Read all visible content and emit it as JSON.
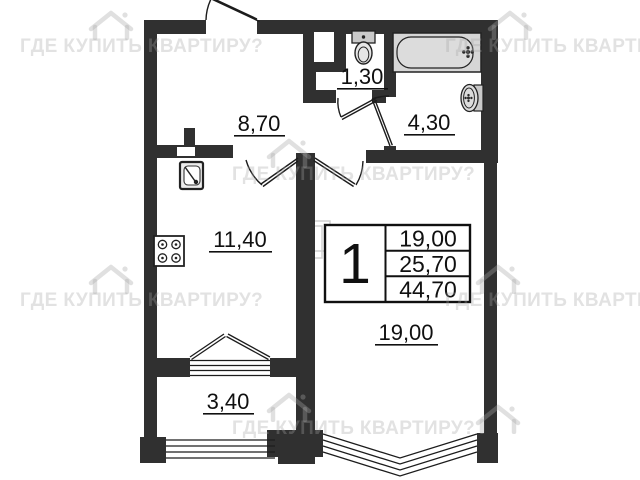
{
  "page": {
    "width": 640,
    "height": 480,
    "background": "#ffffff"
  },
  "watermark": {
    "text": "ГДЕ КУПИТЬ КВАРТИРУ?",
    "icon": "house-icon"
  },
  "floor_plan": {
    "kind": "one-room apartment plan",
    "rooms": [
      {
        "name": "hallway",
        "area_m2": "8,70"
      },
      {
        "name": "wc",
        "area_m2": "1,30"
      },
      {
        "name": "bathroom",
        "area_m2": "4,30"
      },
      {
        "name": "kitchen",
        "area_m2": "11,40"
      },
      {
        "name": "living-room",
        "area_m2": "19,00"
      },
      {
        "name": "balcony",
        "area_m2": "3,40"
      }
    ],
    "info_table": {
      "rooms_count": "1",
      "living_area": "19,00",
      "apartment_area": "25,70",
      "total_area": "44,70"
    },
    "fixtures": [
      "toilet",
      "bathtub",
      "wash-basin",
      "kitchen-sink",
      "stove"
    ],
    "colors": {
      "wall": "#303030",
      "line": "#222222",
      "fixture_fill": "#d6d6d6",
      "label": "#101010"
    }
  }
}
